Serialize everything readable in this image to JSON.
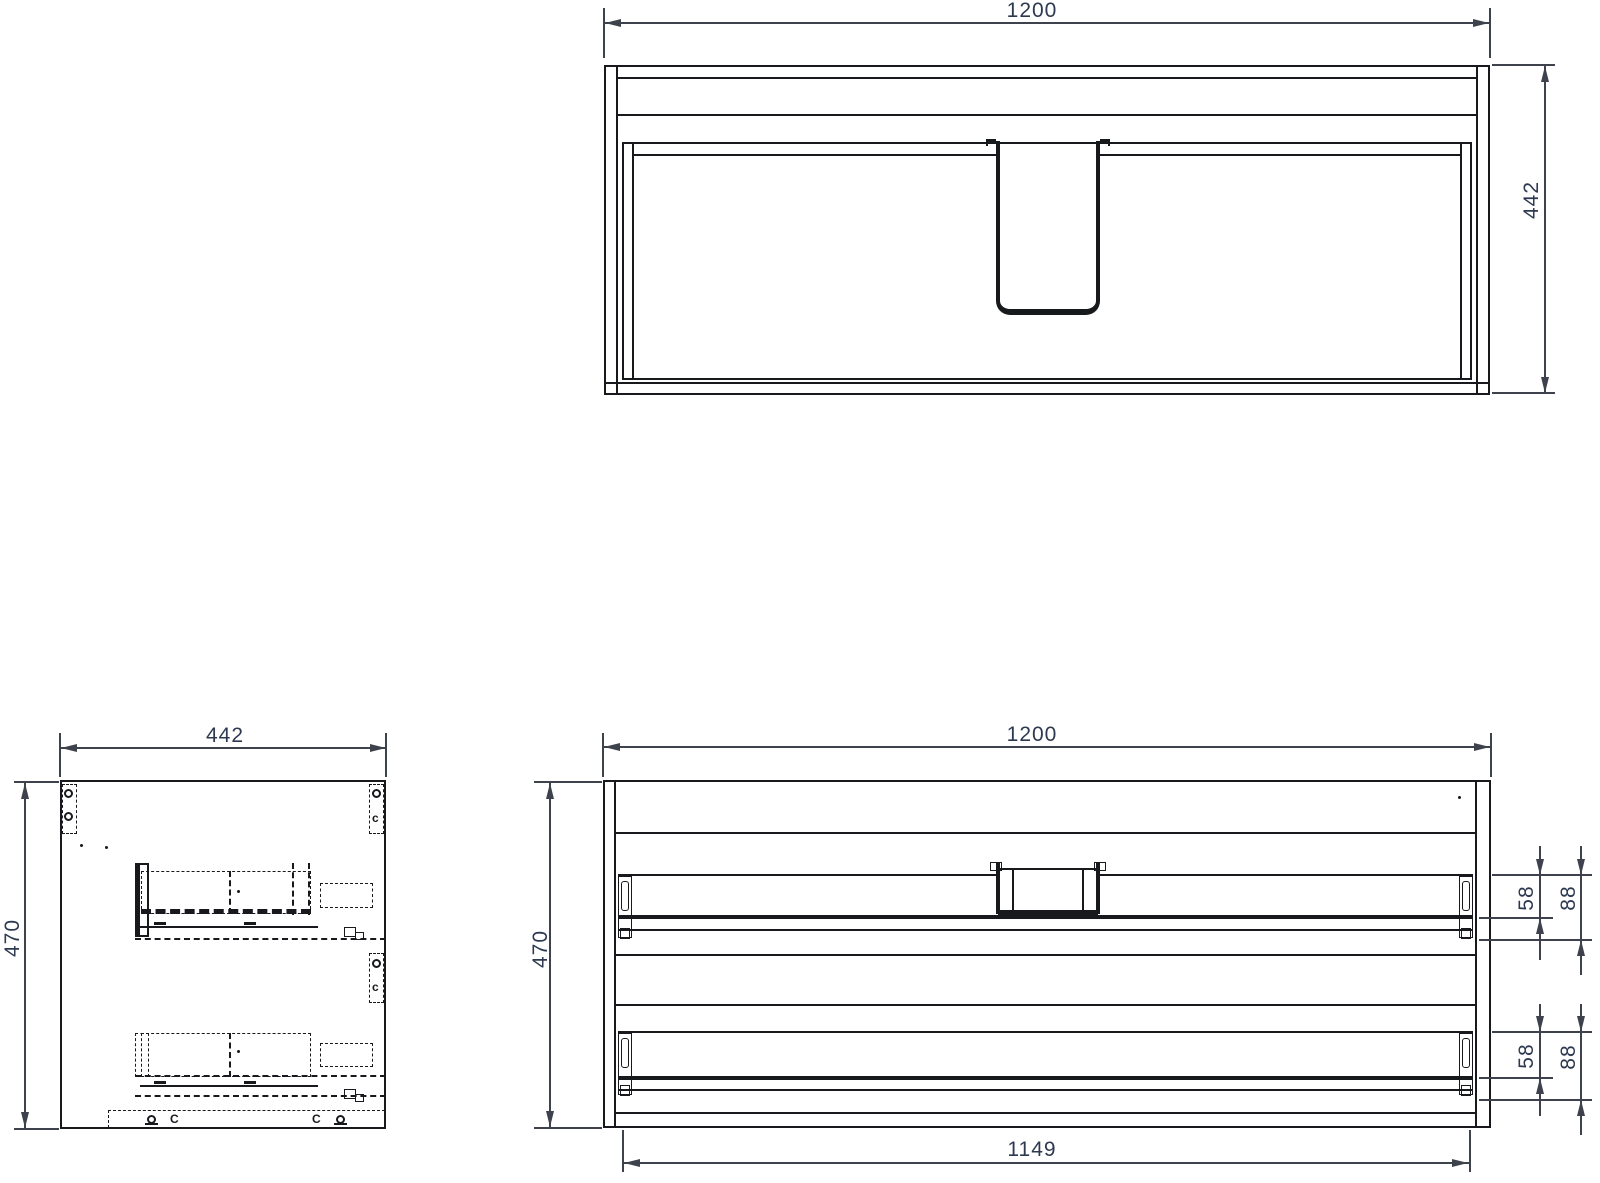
{
  "colors": {
    "background": "#ffffff",
    "line": "#17191d",
    "dimension": "#3d424d",
    "label": "#2d3950"
  },
  "views": {
    "top": {
      "dim_width": "1200",
      "dim_depth": "442"
    },
    "side": {
      "dim_width": "442",
      "dim_height": "470",
      "fitting_letters": [
        "c",
        "c",
        "C",
        "C"
      ]
    },
    "front": {
      "dim_width": "1200",
      "dim_height": "470",
      "dim_inner_width": "1149",
      "upper_drawer": {
        "dim_rail": "58",
        "dim_total": "88"
      },
      "lower_drawer": {
        "dim_rail": "58",
        "dim_total": "88"
      }
    }
  }
}
